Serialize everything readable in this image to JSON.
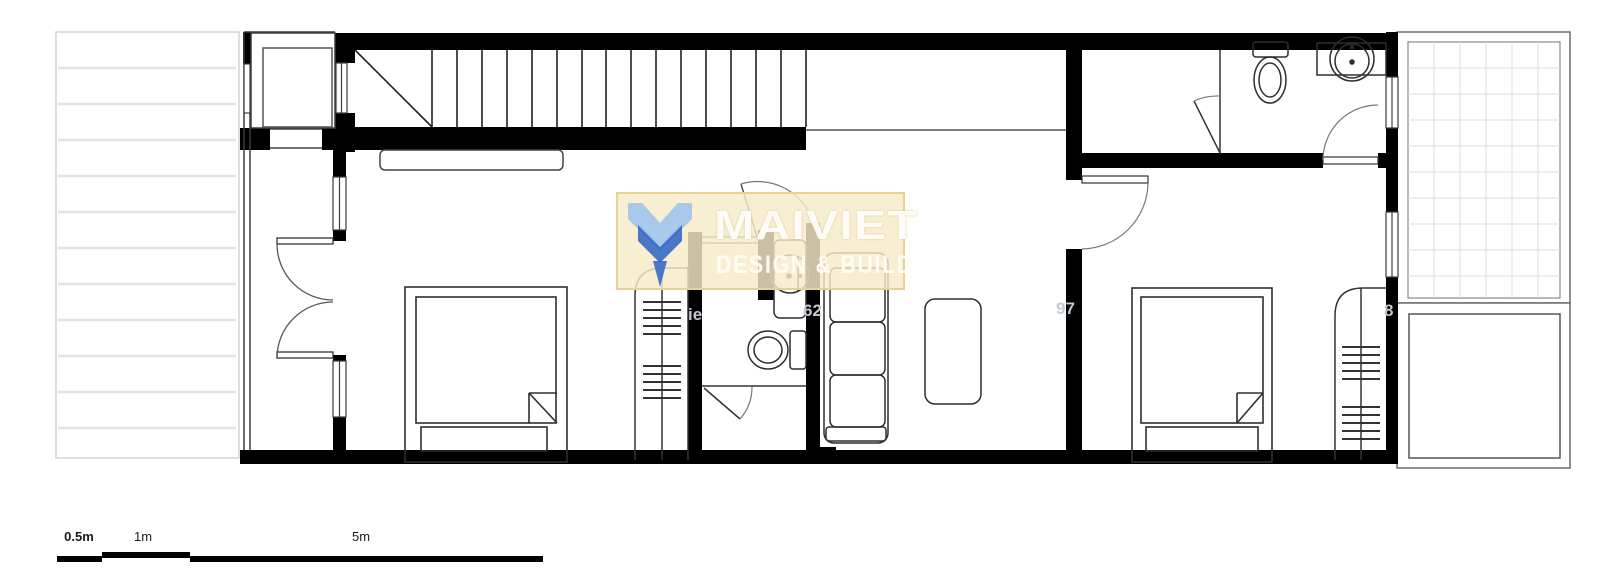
{
  "document": {
    "type": "architectural floor plan",
    "content_notes": "black-and-white CAD floor plan, no room labels visible"
  },
  "watermark": {
    "title": "MAIVIET",
    "subtitle": "DESIGN & BUILD",
    "band_color": "#f6ecc9",
    "band_border": "#e7d195",
    "logo_light_blue": "#9fc4ee",
    "logo_dark_blue": "#2d62c3"
  },
  "faint_fragments": {
    "f1": "ie",
    "f2": "62",
    "f3": "97",
    "f4": "8"
  },
  "scale_bar": {
    "label_half": "0.5m",
    "label_one": "1m",
    "label_five": "5m"
  },
  "colors": {
    "wall": "#000000",
    "thin_line": "#3c3c3c",
    "light_grid": "#d8d8d8",
    "hatch_stripe": "#e2e2e2"
  }
}
